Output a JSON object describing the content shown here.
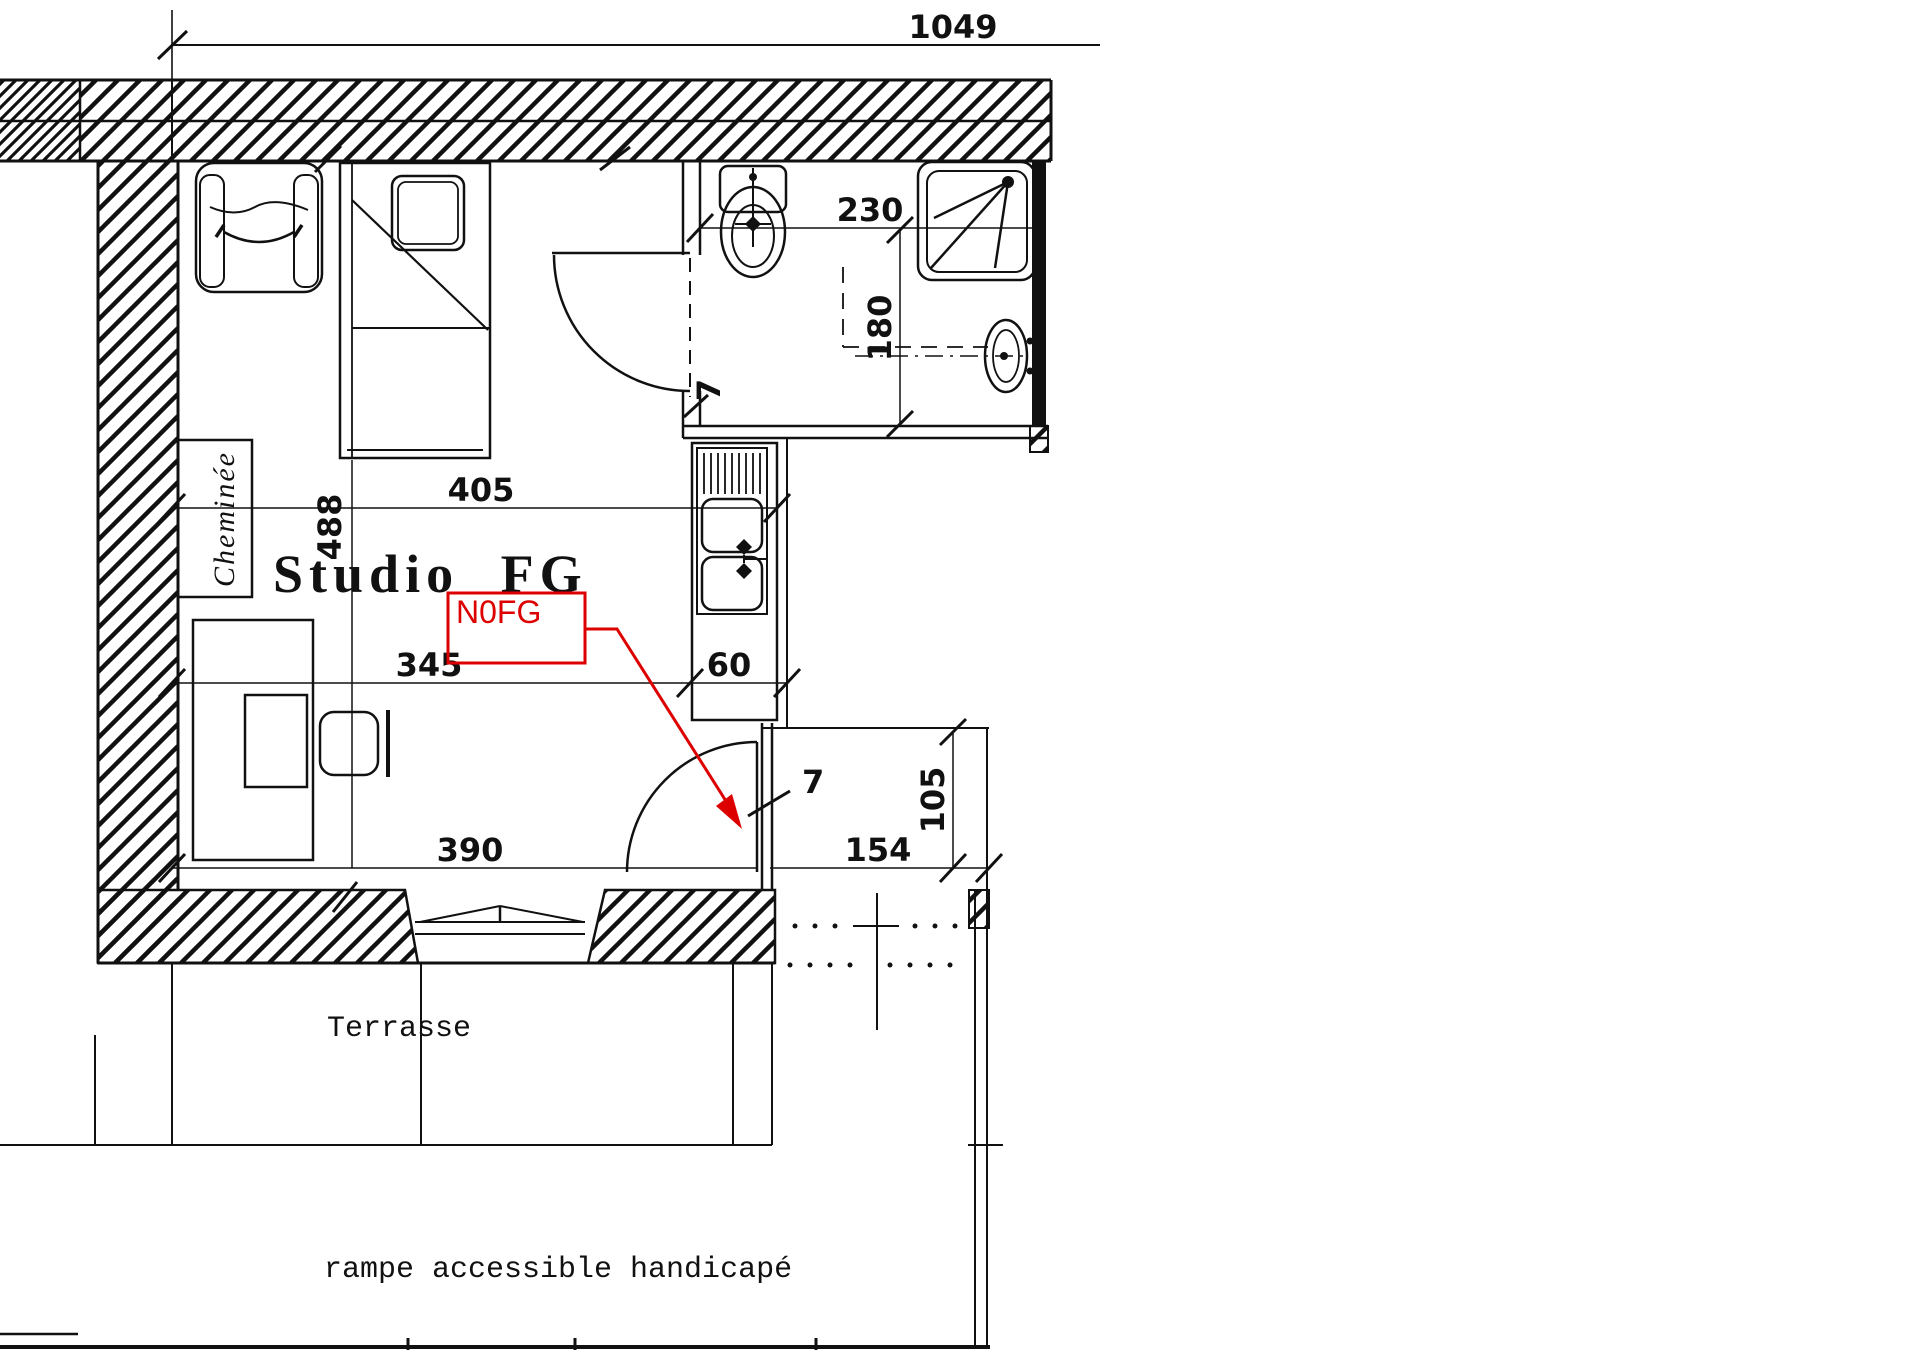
{
  "plan": {
    "room_label": "Studio FG",
    "chimney_label": "Cheminée",
    "terrace_label": "Terrasse",
    "ramp_label": "rampe accessible handicapé",
    "annotation": {
      "text": "N0FG",
      "color": "#dd0000"
    },
    "dims": {
      "overall_width": "1049",
      "room_width": "405",
      "room_length": "488",
      "sitting_zone_width": "345",
      "kitchen_width": "60",
      "lower_width": "390",
      "wc_width": "230",
      "shower_depth": "180",
      "bath_wall_thickness": "7",
      "entry_wall_thickness": "7",
      "landing_width": "154",
      "landing_depth": "105"
    }
  }
}
